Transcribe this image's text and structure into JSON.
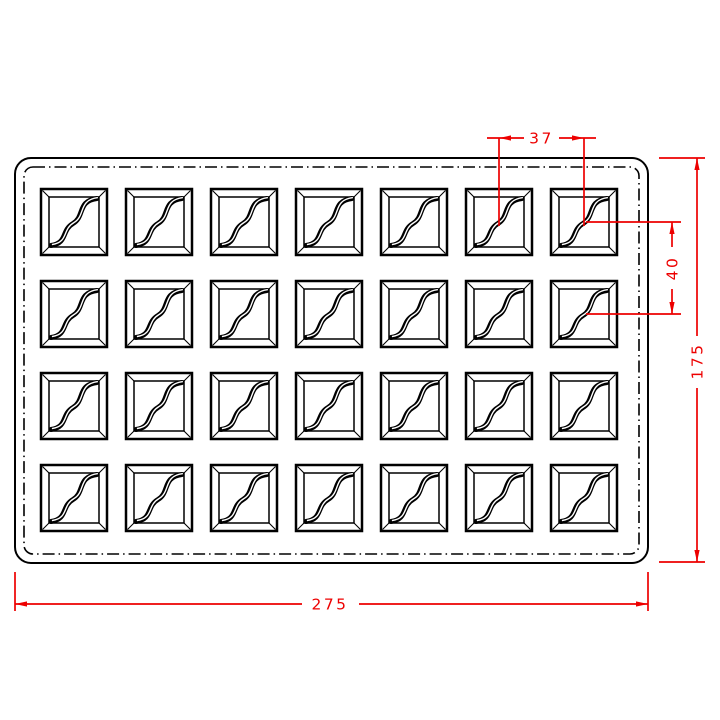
{
  "drawing": {
    "grid": {
      "rows": 4,
      "columns": 7,
      "cavity_count": 28
    },
    "dimensions": {
      "cavity_pitch_horizontal": "37",
      "cavity_pitch_vertical": "40",
      "tray_height": "175",
      "tray_width": "275"
    },
    "colors": {
      "dimension_lines": "#ed0000",
      "outline": "#000000",
      "background": "#ffffff"
    }
  }
}
